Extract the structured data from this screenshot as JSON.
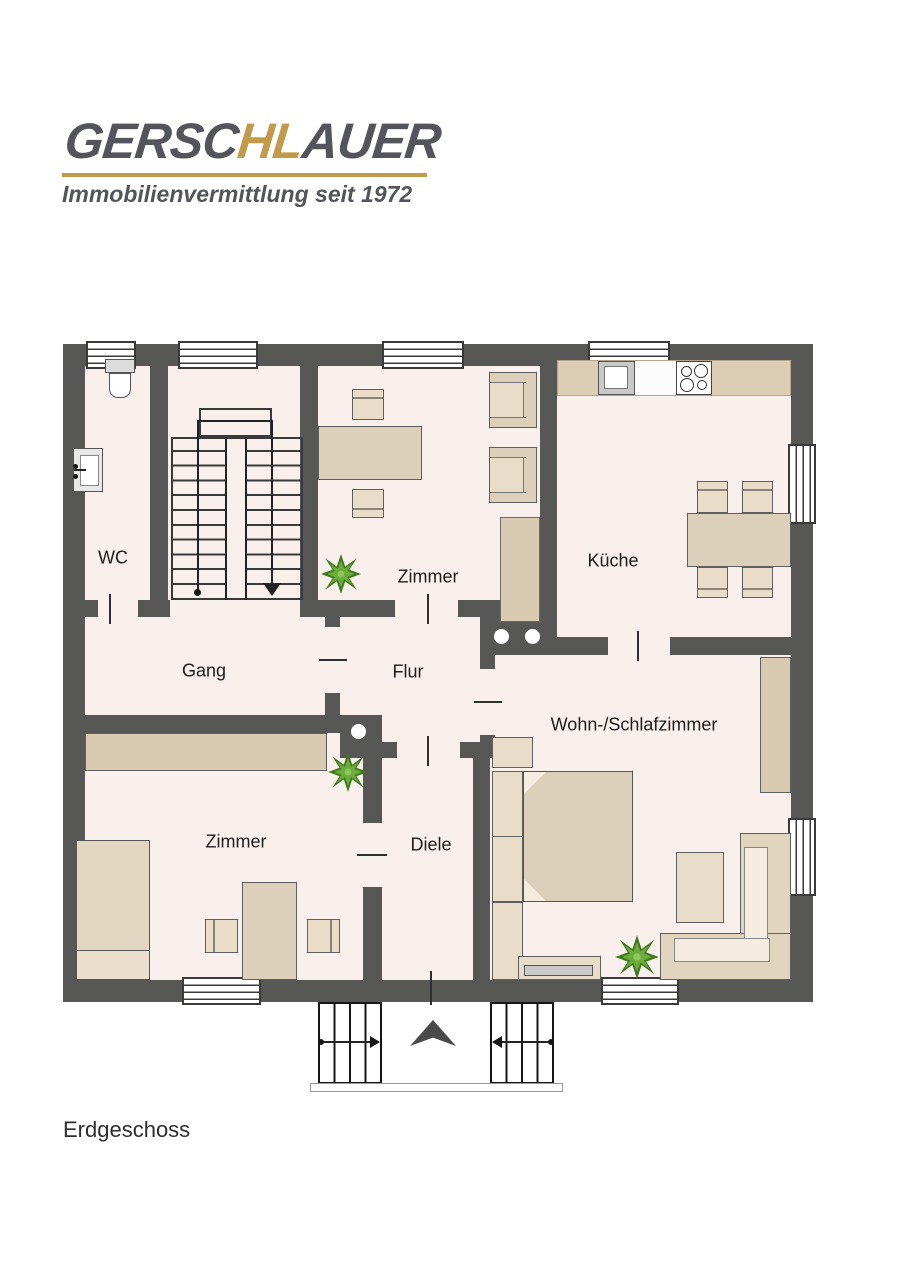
{
  "logo": {
    "brand_left": "GERSC",
    "brand_accent": "HL",
    "brand_right": "AUER",
    "tagline": "Immobilienvermittlung seit 1972"
  },
  "rooms": {
    "wc": "WC",
    "zimmer_top": "Zimmer",
    "kueche": "Küche",
    "gang": "Gang",
    "flur": "Flur",
    "wohn_schlafzimmer": "Wohn-/Schlafzimmer",
    "zimmer_bottom": "Zimmer",
    "diele": "Diele"
  },
  "floor_label": "Erdgeschoss",
  "colors": {
    "wall": "#575756",
    "floor": "#f9efec",
    "furniture_beige": "#ddd0ba",
    "brand_gray": "#54555a",
    "brand_gold": "#c19a4b",
    "plant_green": "#5f9e33"
  }
}
